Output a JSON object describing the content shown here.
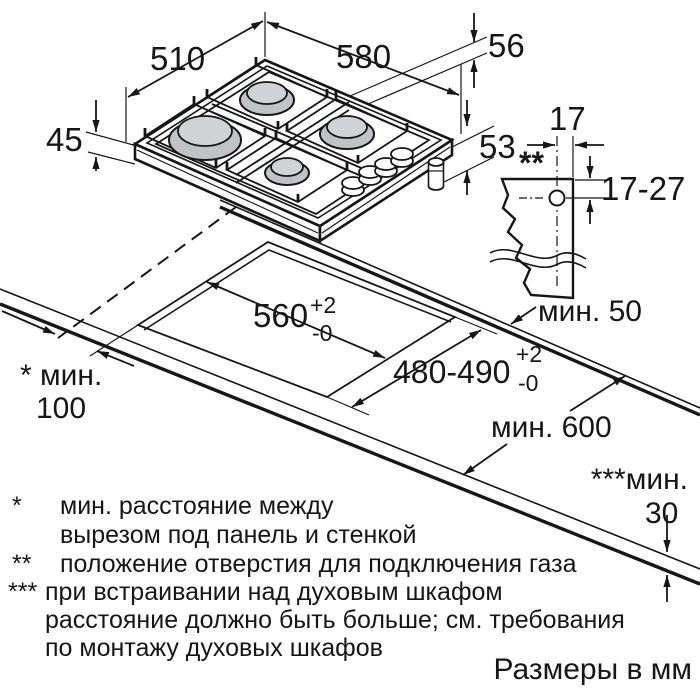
{
  "hob": {
    "width_mm": "580",
    "depth_mm": "510",
    "height_mm": "45",
    "rear_gap_mm": "56",
    "side_gap_mm": "53"
  },
  "gas_connection_detail": {
    "marker": "**",
    "hole_offset_mm": "17",
    "hole_depth_range_mm": "17-27"
  },
  "cutout": {
    "width": {
      "value": "560",
      "tolerance_plus": "+2",
      "tolerance_minus": "-0"
    },
    "depth": {
      "value": "480-490",
      "tolerance_plus": "+2",
      "tolerance_minus": "-0"
    }
  },
  "clearances": {
    "rear_min": "мин. 50",
    "side_min_label": "* мин.",
    "side_min_value": "100",
    "worktop_depth_min": "мин. 600",
    "oven_clearance_label": "***мин.",
    "oven_clearance_value": "30"
  },
  "footnotes": [
    {
      "marker": "*",
      "lines": [
        "мин. расстояние между",
        "вырезом под панель и стенкой"
      ]
    },
    {
      "marker": "**",
      "lines": [
        "положение отверстия для подключения газа"
      ]
    },
    {
      "marker": "***",
      "lines": [
        "при встраивании над духовым шкафом",
        "расстояние должно быть больше; см. требования",
        "по монтажу духовых шкафов"
      ]
    }
  ],
  "units_note": "Размеры в мм",
  "colors": {
    "line": "#161616",
    "burner_base": "#bfc3c6",
    "burner_cap": "#cfd3d6",
    "background": "#ffffff"
  }
}
